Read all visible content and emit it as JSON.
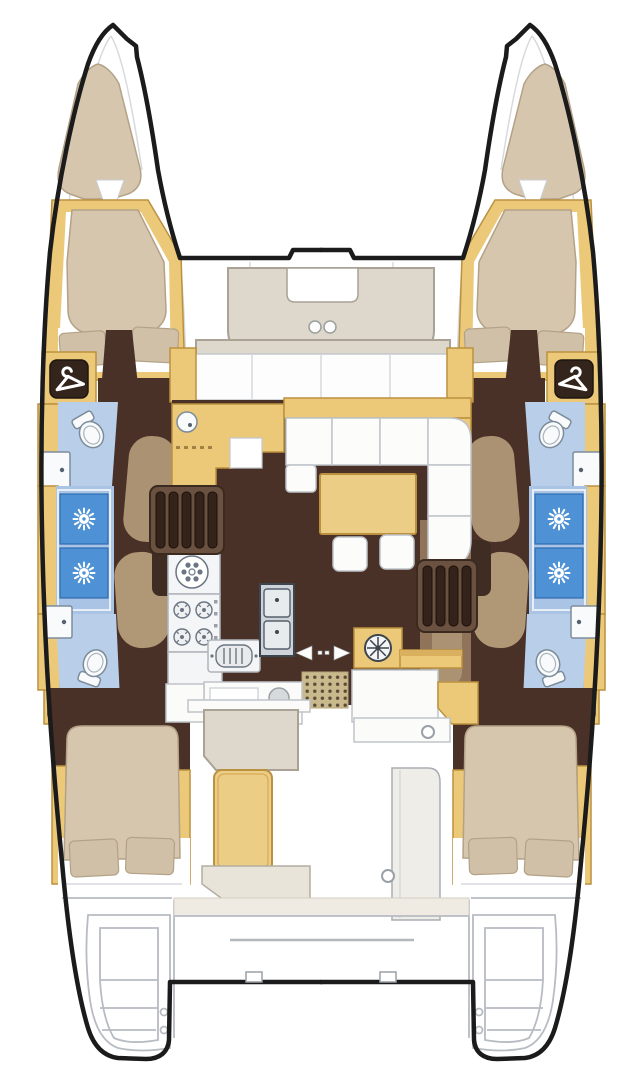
{
  "figure": {
    "kind": "boat-floor-plan",
    "subject": "catamaran yacht accommodation and deck plan, top view",
    "canvas": {
      "width": 643,
      "height": 1080
    }
  },
  "palette": {
    "background": "#ffffff",
    "outline": "#1b1b1b",
    "line_gray": "#b7bcc2",
    "deck_taupe": "#ded7cb",
    "deck_taupe_border": "#a9a295",
    "wood_tan": "#ecc979",
    "wood_tan_dark": "#bb913f",
    "wood_tan_shade": "#d9b05e",
    "floor_brown": "#4a3127",
    "partition_brown": "#8f745a",
    "partition_taupe": "#ab9272",
    "cushion_beige": "#d6c6ae",
    "cushion_border": "#b3a287",
    "pillow_beige": "#cfc0a7",
    "bath_blue": "#b9cfe9",
    "bath_blue_deep": "#a9c4e4",
    "shower_blue": "#4e92d5",
    "shower_blue_dark": "#2f6cb0",
    "fixture_white": "#f8fafb",
    "fixture_outline": "#7d8c9b",
    "mat_tan": "#cbb98e",
    "mat_dot": "#5a4c36",
    "steel_gray": "#cdd3d8",
    "table_tan": "#eccd86"
  },
  "icons": [
    {
      "name": "hanger-icon",
      "meaning": "wardrobe locker",
      "count": 4
    },
    {
      "name": "shower-rose-icon",
      "meaning": "shower drain sunburst",
      "count": 4
    },
    {
      "name": "toilet-icon",
      "meaning": "marine toilet",
      "count": 4
    },
    {
      "name": "sink-icon",
      "meaning": "washbasin",
      "count": 4
    },
    {
      "name": "round-sink-icon",
      "meaning": "galley round sink",
      "count": 1
    },
    {
      "name": "stove-icon",
      "meaning": "4-burner cooktop",
      "count": 1
    },
    {
      "name": "double-sink-icon",
      "meaning": "galley double sink",
      "count": 1
    },
    {
      "name": "oven-icon",
      "meaning": "oven / grill",
      "count": 1
    },
    {
      "name": "winch-icon",
      "meaning": "round deck fitting",
      "count": 1
    },
    {
      "name": "sliding-door-arrows-icon",
      "meaning": "sliding cockpit door",
      "count": 1
    },
    {
      "name": "cup-holder-icon",
      "meaning": "foredeck cup holders",
      "count": 2
    }
  ],
  "rooms": {
    "port_hull": [
      "bow-sunpad",
      "forward-double-cabin",
      "forward-bathroom",
      "shower",
      "aft-bathroom",
      "aft-double-cabin",
      "swim-platform"
    ],
    "starboard_hull": [
      "bow-sunpad",
      "forward-double-cabin",
      "forward-bathroom",
      "shower",
      "aft-bathroom",
      "aft-double-cabin",
      "swim-platform"
    ],
    "main_deck": [
      "foredeck-seating",
      "salon-sofa",
      "salon-table",
      "chart-counter",
      "galley",
      "port-companionway-stairs",
      "starboard-companionway-stairs",
      "entry-mat",
      "cockpit-bench",
      "cockpit-module"
    ]
  }
}
